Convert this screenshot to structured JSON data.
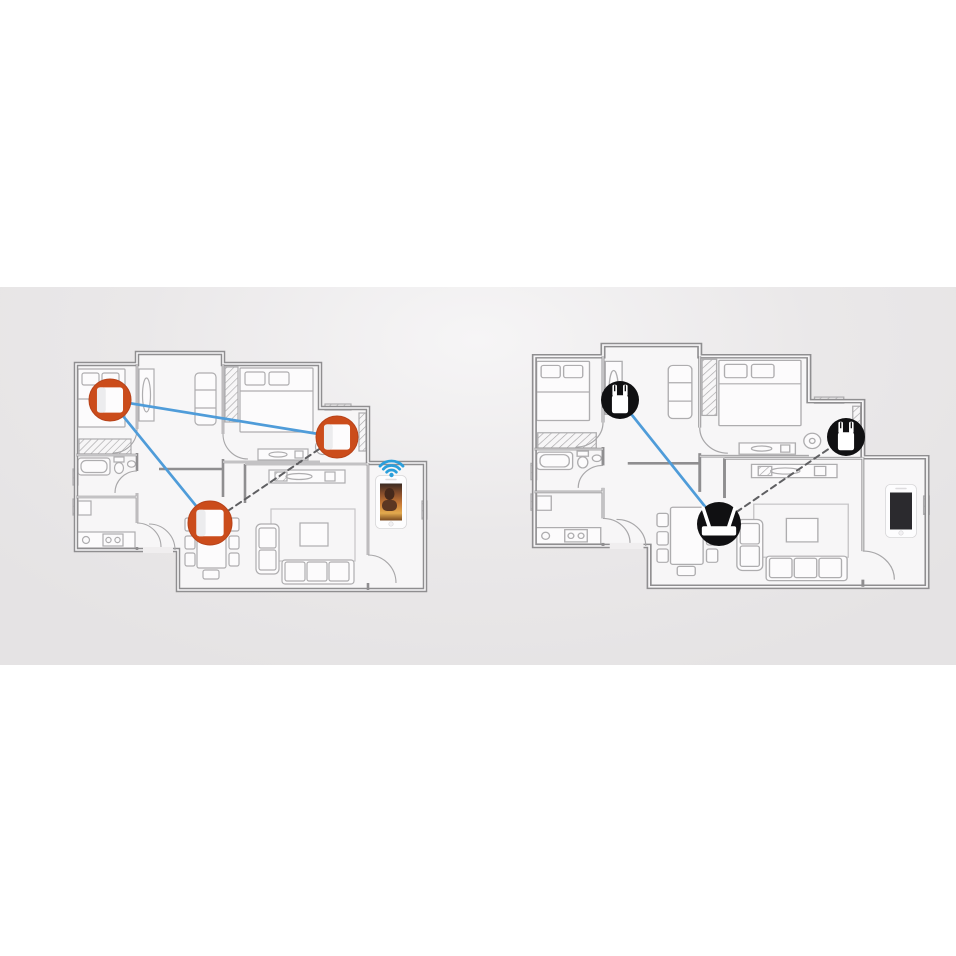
{
  "scene": {
    "background": "#ffffff",
    "band": {
      "top": 287,
      "height": 378
    }
  },
  "palette": {
    "wall": "#8f8e90",
    "furniture": "#aeadaf",
    "floor": "#f7f6f7",
    "mesh_accent": "#cb4c1b",
    "mesh_accent_dark": "#b8431a",
    "device_black": "#101012",
    "link_blue": "#4f9cd9",
    "link_dashed": "#5f5f62",
    "wifi_blue": "#2b9fdb",
    "phone_body": "#fdfdfe",
    "phone_screen_off": "#2b2a2e"
  },
  "panels": [
    {
      "id": "mesh-wifi-home",
      "house": {
        "x": 73,
        "y": 351,
        "sx": 1.0,
        "sy": 1.0
      },
      "devices": [
        {
          "type": "mesh-node",
          "x": 110,
          "y": 400,
          "r": 21
        },
        {
          "type": "mesh-node",
          "x": 337,
          "y": 437,
          "r": 21
        },
        {
          "type": "mesh-node",
          "x": 210,
          "y": 523,
          "r": 22
        }
      ],
      "links": [
        {
          "from": 0,
          "to": 1,
          "style": "solid"
        },
        {
          "from": 0,
          "to": 2,
          "style": "solid"
        },
        {
          "from": 2,
          "to": 1,
          "style": "dashed"
        }
      ],
      "phone": {
        "x": 391,
        "y": 502,
        "screen": "video",
        "wifi": true
      }
    },
    {
      "id": "range-extender-home",
      "house": {
        "x": 531,
        "y": 343,
        "sx": 1.125,
        "sy": 1.02
      },
      "devices": [
        {
          "type": "extender",
          "x": 620,
          "y": 400,
          "r": 19
        },
        {
          "type": "extender",
          "x": 846,
          "y": 437,
          "r": 19
        },
        {
          "type": "router",
          "x": 719,
          "y": 524,
          "r": 22
        }
      ],
      "links": [
        {
          "from": 0,
          "to": 2,
          "style": "solid"
        },
        {
          "from": 2,
          "to": 1,
          "style": "dashed"
        }
      ],
      "phone": {
        "x": 901,
        "y": 511,
        "screen": "off",
        "wifi": false
      }
    }
  ]
}
